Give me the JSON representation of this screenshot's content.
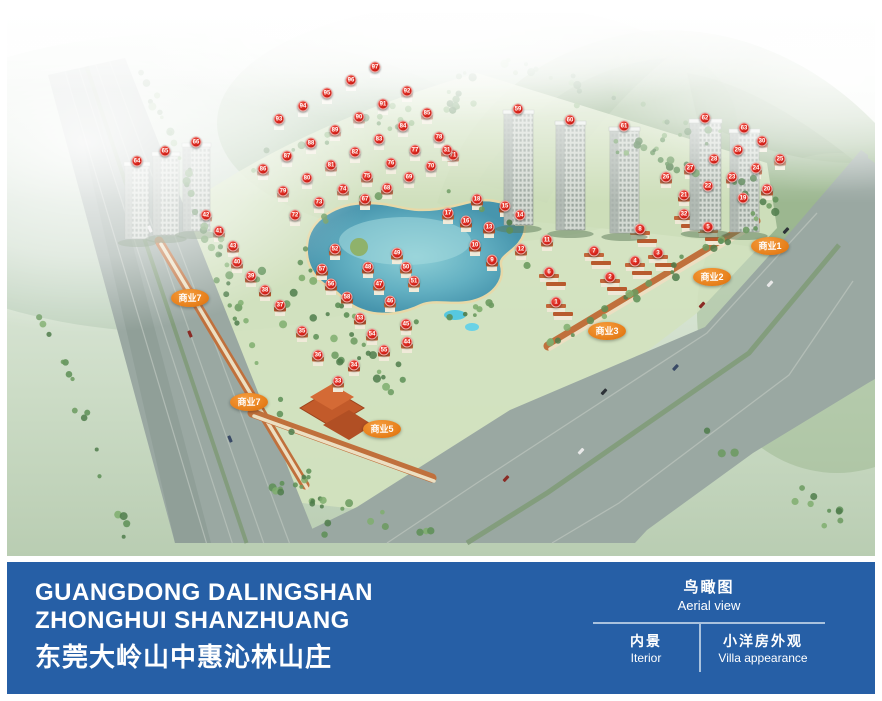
{
  "aerial_view": {
    "caption": "鸟瞰图 Aerial view of the masterplan",
    "marker_color": "#d9251c",
    "commercial_label_color": "#e8821e",
    "commercial_labels": [
      {
        "label": "商业1",
        "x": 763,
        "y": 233
      },
      {
        "label": "商业2",
        "x": 705,
        "y": 264
      },
      {
        "label": "商业3",
        "x": 600,
        "y": 318
      },
      {
        "label": "商业5",
        "x": 375,
        "y": 416
      },
      {
        "label": "商业7",
        "x": 183,
        "y": 285
      },
      {
        "label": "商业7",
        "x": 242,
        "y": 389
      }
    ],
    "unit_markers": [
      [
        97,
        368,
        54
      ],
      [
        96,
        344,
        67
      ],
      [
        95,
        320,
        80
      ],
      [
        94,
        296,
        93
      ],
      [
        93,
        272,
        106
      ],
      [
        92,
        400,
        78
      ],
      [
        91,
        376,
        91
      ],
      [
        90,
        352,
        104
      ],
      [
        89,
        328,
        117
      ],
      [
        88,
        304,
        130
      ],
      [
        87,
        280,
        143
      ],
      [
        86,
        256,
        156
      ],
      [
        85,
        420,
        100
      ],
      [
        84,
        396,
        113
      ],
      [
        83,
        372,
        126
      ],
      [
        82,
        348,
        139
      ],
      [
        81,
        324,
        152
      ],
      [
        80,
        300,
        165
      ],
      [
        79,
        276,
        178
      ],
      [
        78,
        432,
        124
      ],
      [
        77,
        408,
        137
      ],
      [
        76,
        384,
        150
      ],
      [
        75,
        360,
        163
      ],
      [
        74,
        336,
        176
      ],
      [
        73,
        312,
        189
      ],
      [
        72,
        288,
        202
      ],
      [
        71,
        446,
        142
      ],
      [
        70,
        424,
        153
      ],
      [
        69,
        402,
        164
      ],
      [
        68,
        380,
        175
      ],
      [
        67,
        358,
        186
      ],
      [
        30,
        755,
        128
      ],
      [
        29,
        731,
        137
      ],
      [
        28,
        707,
        146
      ],
      [
        27,
        683,
        155
      ],
      [
        26,
        659,
        164
      ],
      [
        25,
        773,
        146
      ],
      [
        24,
        749,
        155
      ],
      [
        23,
        725,
        164
      ],
      [
        22,
        701,
        173
      ],
      [
        21,
        677,
        182
      ],
      [
        20,
        760,
        176
      ],
      [
        19,
        736,
        185
      ],
      [
        31,
        440,
        137
      ],
      [
        18,
        470,
        186
      ],
      [
        17,
        441,
        200
      ],
      [
        16,
        459,
        208
      ],
      [
        15,
        498,
        193
      ],
      [
        14,
        513,
        202
      ],
      [
        13,
        482,
        214
      ],
      [
        12,
        514,
        236
      ],
      [
        11,
        540,
        227
      ],
      [
        10,
        468,
        232
      ],
      [
        9,
        485,
        247
      ],
      [
        8,
        633,
        216
      ],
      [
        7,
        587,
        238
      ],
      [
        6,
        542,
        259
      ],
      [
        5,
        701,
        214
      ],
      [
        4,
        628,
        248
      ],
      [
        3,
        651,
        240
      ],
      [
        2,
        603,
        264
      ],
      [
        1,
        549,
        289
      ],
      [
        32,
        677,
        201
      ],
      [
        40,
        230,
        249
      ],
      [
        39,
        244,
        263
      ],
      [
        38,
        258,
        277
      ],
      [
        37,
        273,
        292
      ],
      [
        35,
        295,
        318
      ],
      [
        36,
        311,
        342
      ],
      [
        33,
        331,
        368
      ],
      [
        34,
        347,
        352
      ],
      [
        42,
        199,
        202
      ],
      [
        41,
        212,
        218
      ],
      [
        43,
        226,
        233
      ],
      [
        52,
        328,
        236
      ],
      [
        57,
        315,
        256
      ],
      [
        56,
        324,
        271
      ],
      [
        58,
        340,
        284
      ],
      [
        53,
        353,
        305
      ],
      [
        54,
        365,
        321
      ],
      [
        55,
        377,
        337
      ],
      [
        48,
        361,
        254
      ],
      [
        47,
        372,
        271
      ],
      [
        46,
        383,
        288
      ],
      [
        49,
        390,
        240
      ],
      [
        50,
        399,
        254
      ],
      [
        51,
        407,
        268
      ],
      [
        45,
        399,
        311
      ],
      [
        44,
        400,
        329
      ],
      [
        64,
        130,
        148
      ],
      [
        65,
        158,
        138
      ],
      [
        66,
        189,
        129
      ],
      [
        59,
        511,
        96
      ],
      [
        60,
        563,
        107
      ],
      [
        61,
        617,
        113
      ],
      [
        62,
        698,
        105
      ],
      [
        63,
        737,
        115
      ]
    ],
    "tower_marker_numbers": [
      59,
      60,
      61,
      62,
      63,
      64,
      65,
      66
    ]
  },
  "footer": {
    "bar_color": "#265fa6",
    "title_en_line1": "GUANGDONG DALINGSHAN",
    "title_en_line2": "ZHONGHUI SHANZHUANG",
    "title_cn": "东莞大岭山中惠沁林山庄",
    "views": {
      "current": {
        "cn": "鸟瞰图",
        "en": "Aerial view"
      },
      "tabs": [
        {
          "cn": "内景",
          "en": "Iterior"
        },
        {
          "cn": "小洋房外观",
          "en": "Villa appearance"
        }
      ]
    }
  }
}
